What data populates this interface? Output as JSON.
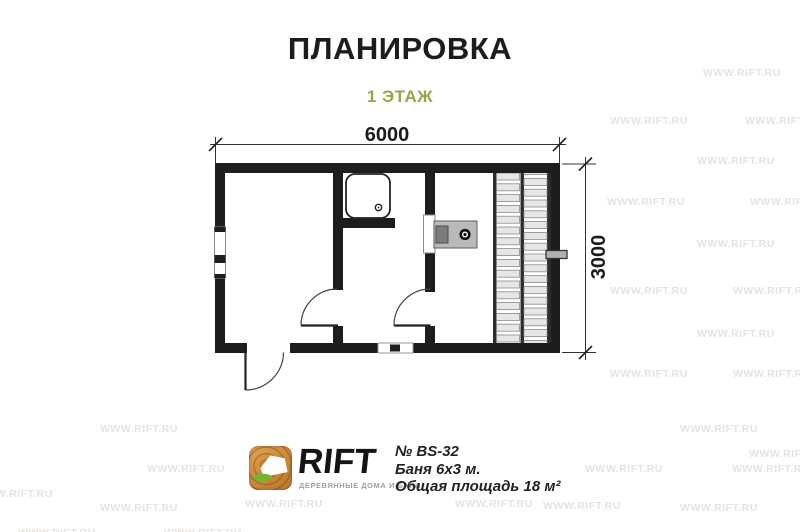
{
  "title": "ПЛАНИРОВКА",
  "subtitle": "1 ЭТАЖ",
  "dimensions": {
    "width_label": "6000",
    "height_label": "3000"
  },
  "colors": {
    "subtitle_green": "#97a647",
    "wall_black": "#1d1d1d",
    "stove_body_gray": "#b9b9b9",
    "firebox_gray": "#7c7c7c",
    "bench_plank_gray": "#e6e6e6",
    "watermark_gray": "#e7e3de",
    "logo_wood_orange": "#cf8c3d",
    "logo_leaf_green": "#76b32f"
  },
  "watermark": {
    "text": "WWW.RIFT.RU",
    "positions": [
      [
        703,
        67
      ],
      [
        610,
        115
      ],
      [
        745,
        115
      ],
      [
        697,
        155
      ],
      [
        607,
        196
      ],
      [
        750,
        196
      ],
      [
        697,
        238
      ],
      [
        610,
        285
      ],
      [
        733,
        285
      ],
      [
        697,
        328
      ],
      [
        610,
        368
      ],
      [
        733,
        368
      ],
      [
        100,
        423
      ],
      [
        680,
        423
      ],
      [
        749,
        448
      ],
      [
        147,
        463
      ],
      [
        585,
        463
      ],
      [
        732,
        463
      ],
      [
        -25,
        488
      ],
      [
        100,
        502
      ],
      [
        245,
        498
      ],
      [
        455,
        498
      ],
      [
        543,
        500
      ],
      [
        680,
        502
      ],
      [
        18,
        527
      ],
      [
        164,
        527
      ]
    ]
  },
  "logo": {
    "brand": "RIFT",
    "tagline": "ДЕРЕВЯННЫЕ ДОМА И БАНИ"
  },
  "specs": {
    "model": "№ BS-32",
    "name": "Баня 6х3 м.",
    "area": "Общая площадь 18 м²"
  }
}
